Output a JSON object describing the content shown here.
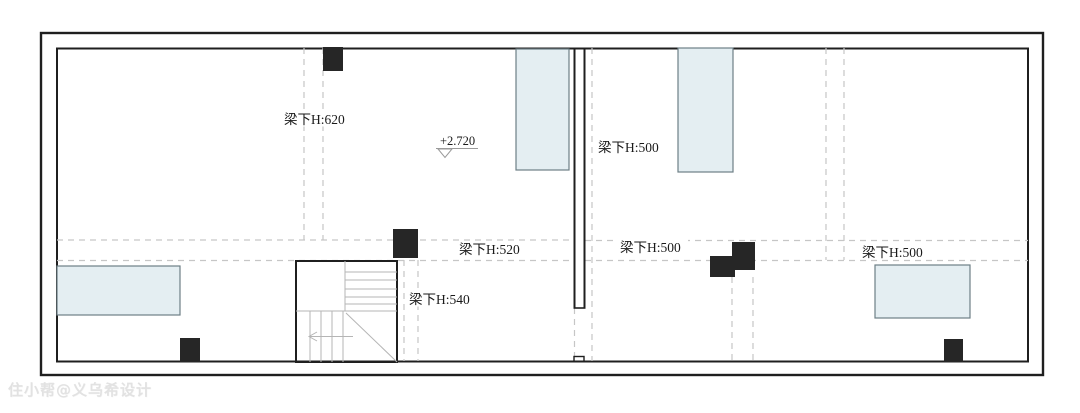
{
  "plan": {
    "beam_labels": [
      {
        "id": "beam-620",
        "text": "梁下H:620"
      },
      {
        "id": "beam-500-center",
        "text": "梁下H:500"
      },
      {
        "id": "beam-520",
        "text": "梁下H:520"
      },
      {
        "id": "beam-500-mid",
        "text": "梁下H:500"
      },
      {
        "id": "beam-500-right",
        "text": "梁下H:500"
      },
      {
        "id": "beam-540",
        "text": "梁下H:540"
      }
    ],
    "elevation_marker": {
      "text": "+2.720"
    },
    "watermark": "住小帮@义乌希设计",
    "colors": {
      "wall": "#1f1f1f",
      "column": "#262626",
      "beam_dash": "#c6c6c6",
      "stair": "#b5b5b5",
      "panel_fill": "#e4eef2",
      "panel_stroke": "#6d7f86",
      "label": "#1a1a1a",
      "watermark": "#e2e2e2"
    }
  }
}
